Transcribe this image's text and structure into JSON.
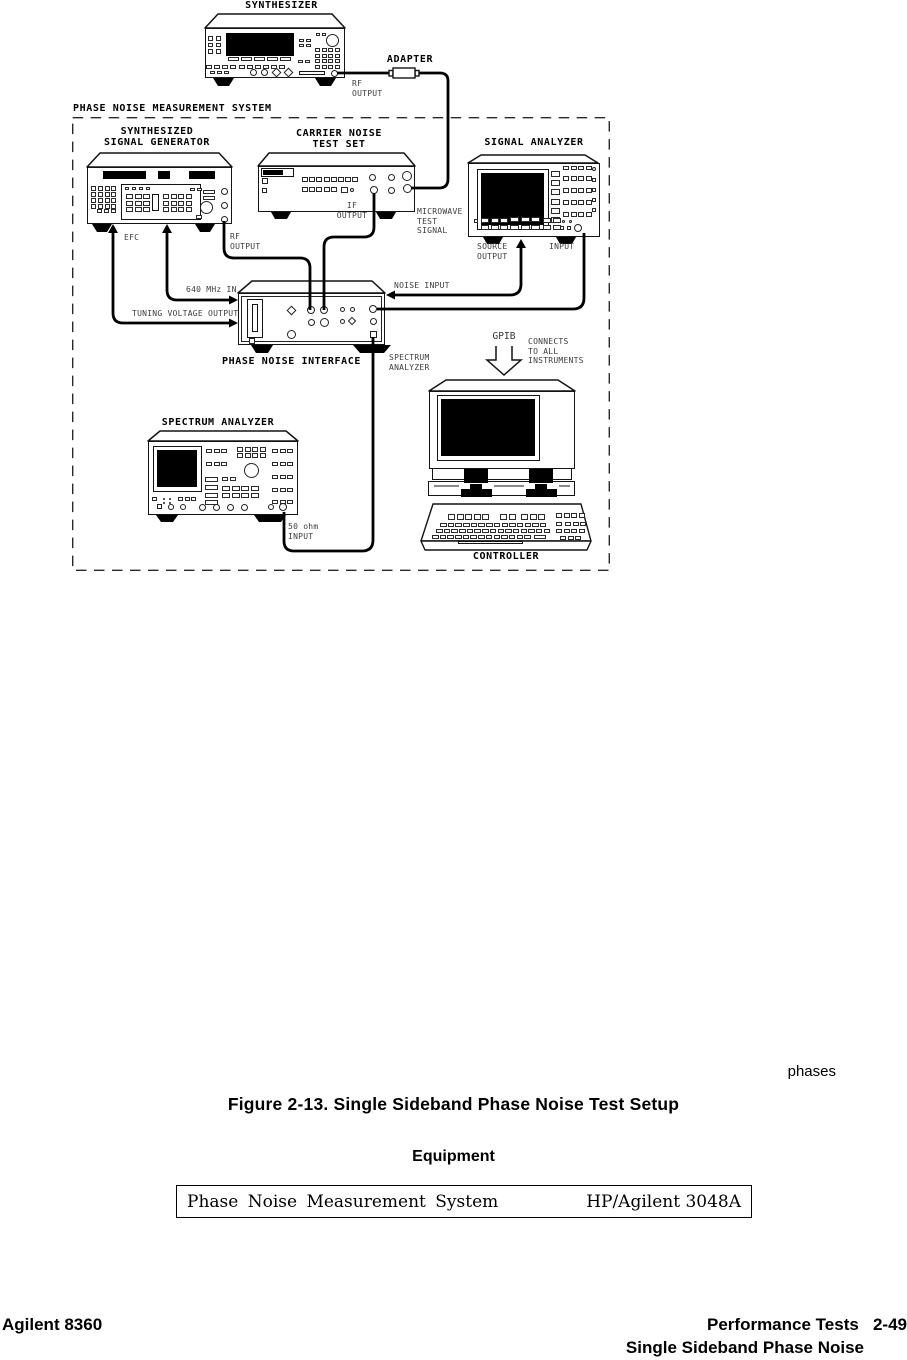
{
  "diagram": {
    "system_box_label": "PHASE NOISE MEASUREMENT SYSTEM",
    "synthesizer": {
      "title": "SYNTHESIZER",
      "rf_output_label": "RF\nOUTPUT",
      "adapter_label": "ADAPTER"
    },
    "signal_generator": {
      "title": "SYNTHESIZED\nSIGNAL GENERATOR",
      "efc_label": "EFC",
      "rf_output_label": "RF\nOUTPUT"
    },
    "carrier_noise_test_set": {
      "title": "CARRIER NOISE\nTEST SET",
      "if_output_label": "IF\nOUTPUT",
      "microwave_label": "MICROWAVE\nTEST\nSIGNAL"
    },
    "signal_analyzer": {
      "title": "SIGNAL ANALYZER",
      "source_output_label": "SOURCE\nOUTPUT",
      "input_label": "INPUT"
    },
    "phase_noise_interface": {
      "title": "PHASE NOISE INTERFACE",
      "mhz_in_label": "640 MHz IN",
      "tuning_label": "TUNING VOLTAGE OUTPUT",
      "noise_input_label": "NOISE INPUT",
      "spectrum_analyzer_port_label": "SPECTRUM\nANALYZER"
    },
    "spectrum_analyzer": {
      "title": "SPECTRUM ANALYZER",
      "input_label": "50  ohm\nINPUT"
    },
    "controller": {
      "title": "CONTROLLER",
      "gpib_label": "GPIB",
      "gpib_note": "CONNECTS\nTO  ALL\nINSTRUMENTS"
    }
  },
  "caption": {
    "margin_note": "phases",
    "figure_caption": "Figure 2-13. Single Sideband Phase Noise Test Setup",
    "equipment_heading": "Equipment"
  },
  "equipment_table": {
    "rows": [
      {
        "item": "Phase Noise Measurement System",
        "model": "HP/Agilent 3048A"
      }
    ]
  },
  "footer": {
    "product": "Agilent 8360",
    "section": "Performance Tests   2-49",
    "subsection": "Single Sideband Phase Noise"
  }
}
